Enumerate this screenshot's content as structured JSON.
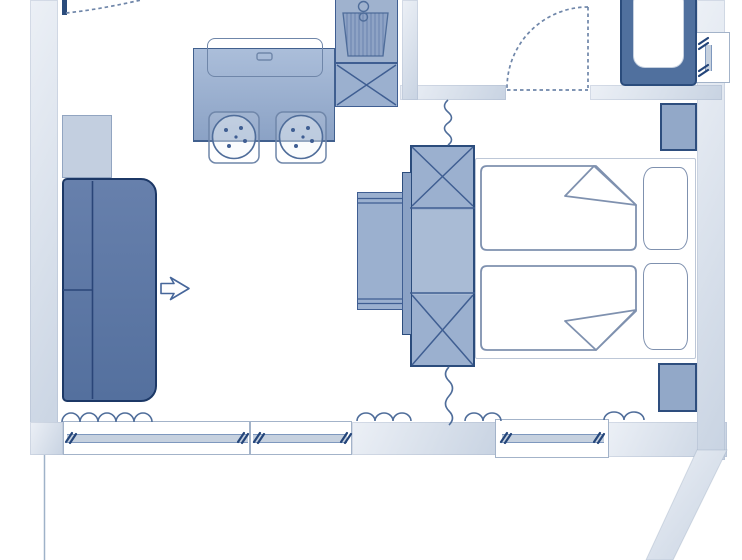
{
  "app": {
    "name": "floor-plan-viewer",
    "description": "studio apartment floor plan drawing, blue line-art style, no visible text"
  },
  "plan": {
    "kind": "studio-apartment-floor-plan",
    "areas": {
      "entry": [
        "entry-door",
        "entry-door-swing"
      ],
      "living": [
        "sofa",
        "side-table",
        "sofa-extension-arrow"
      ],
      "kitchen": [
        "upper-cabinet-outline",
        "kitchen-counter",
        "stove-burner-left",
        "stove-burner-right",
        "kitchen-sink",
        "sink-base-cabinet-x"
      ],
      "bathroom": [
        "bathroom-door-swing",
        "bathtub",
        "bathroom-window"
      ],
      "sleeping": [
        "wardrobe-x-top",
        "wardrobe-middle",
        "wardrobe-x-bottom",
        "desk",
        "desk-side-panel",
        "double-bed",
        "duvet-top",
        "duvet-bottom",
        "pillow-top",
        "pillow-bottom",
        "wall-niche-top",
        "wall-niche-bottom",
        "privacy-curtain-squiggle-top",
        "privacy-curtain-squiggle-bottom"
      ],
      "facade": [
        "window-band-left",
        "window-band-right",
        "curtain-squiggles",
        "window-opening-ticks",
        "balcony-boundary-line",
        "diagonal-wall"
      ]
    }
  },
  "colors": {
    "bg": "#ffffff",
    "wall-light": "#ecf0f6",
    "wall-dark": "#c8d3e2",
    "furn-fill": "#9bb0cf",
    "furn-border": "#3f5e92",
    "furn-border-dark": "#2b4c7c",
    "sofa-fill-1": "#6780ac",
    "sofa-fill-2": "#54709e",
    "sofa-border": "#1c3866",
    "sofa-line": "#2a4578",
    "table-fill": "#c3cfe0",
    "table-border": "#92a5c1",
    "counter-top": "#abbeda",
    "counter-bottom": "#8ba2c5",
    "counter-border": "#41608e",
    "sink-fill": "#9fb2ce",
    "bowl-fill": "#8ea3c5",
    "tub-fill": "#50709e",
    "tub-inner-border": "#c6d1e0",
    "niche-fill": "#92a8c8",
    "niche-border": "#2e4e7e",
    "bed-border": "#7f91af",
    "bed-frame-border": "#bdc7d7",
    "line": "#4f6d9a",
    "dash": "#6f86a9",
    "glaze-fill": "#c6d1df",
    "glaze-edge": "#7e98be",
    "window-border": "#a3b3c9",
    "tick": "#24457a",
    "arrow": "#46669a",
    "balcony": "#9fb2c8"
  }
}
